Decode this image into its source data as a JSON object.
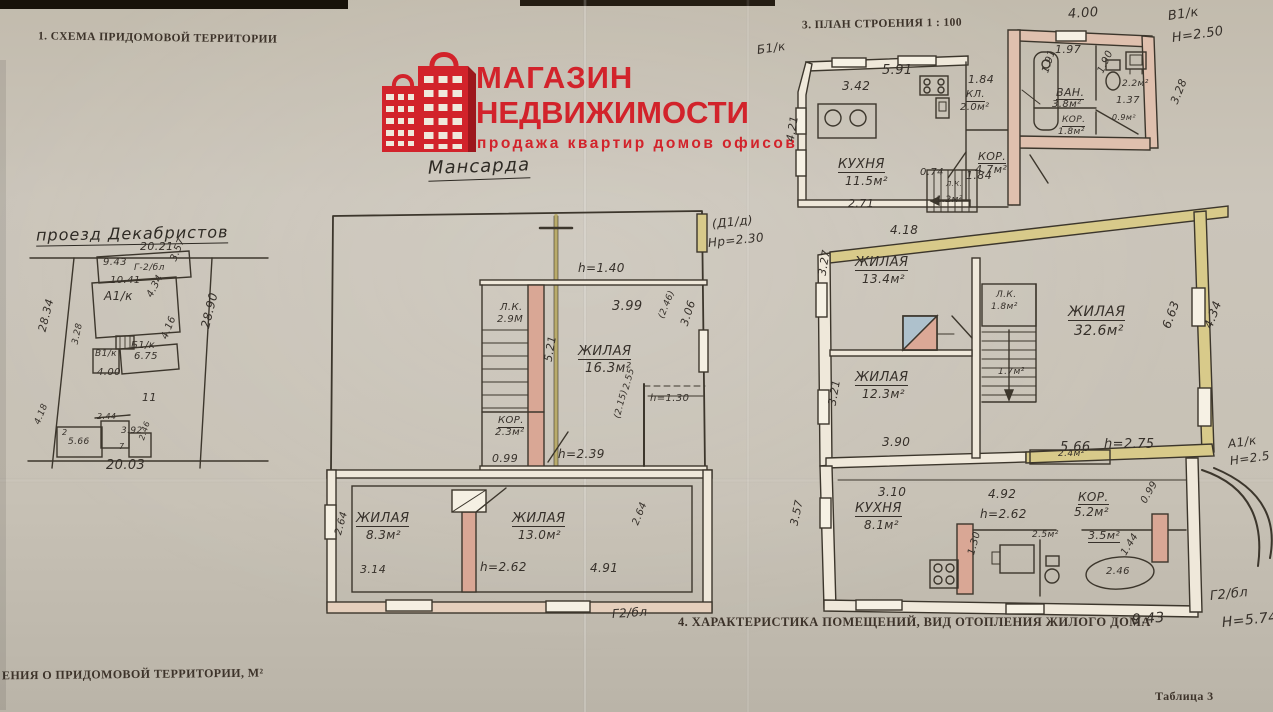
{
  "page": {
    "section1_title": "1. СХЕМА ПРИДОМОВОЙ ТЕРРИТОРИИ",
    "section3_title": "3. ПЛАН СТРОЕНИЯ 1 : 100",
    "section4_title": "4. ХАРАКТЕРИСТИКА ПОМЕЩЕНИЙ, ВИД ОТОПЛЕНИЯ ЖИЛОГО ДОМА",
    "bottom_left_text": "ЕНИЯ О ПРИДОМОВОЙ ТЕРРИТОРИИ, М²",
    "table_ref": "Таблица 3"
  },
  "logo": {
    "line1": "МАГАЗИН",
    "line2": "НЕДВИЖИМОСТИ",
    "tagline": "продажа  квартир  домов  офисов",
    "brand_color": "#d2232b",
    "icon": "buildings-bag-icon"
  },
  "site_plan": {
    "street_name": "проезд Декабристов",
    "labels": [
      {
        "t": "20.21",
        "x": 140,
        "y": 241,
        "fs": 11
      },
      {
        "t": "28.34",
        "x": 42,
        "y": 326,
        "fs": 11,
        "r": -76
      },
      {
        "t": "28.90",
        "x": 205,
        "y": 322,
        "fs": 12,
        "r": -76
      },
      {
        "t": "9.43",
        "x": 103,
        "y": 258,
        "fs": 10
      },
      {
        "t": "Г-2/бл",
        "x": 134,
        "y": 264,
        "fs": 9
      },
      {
        "t": "3.57",
        "x": 174,
        "y": 256,
        "fs": 10,
        "r": -68
      },
      {
        "t": "10.41",
        "x": 110,
        "y": 276,
        "fs": 10
      },
      {
        "t": "А1/к",
        "x": 104,
        "y": 290,
        "fs": 12
      },
      {
        "t": "4.34",
        "x": 150,
        "y": 292,
        "fs": 10,
        "r": -62
      },
      {
        "t": "4.16",
        "x": 165,
        "y": 334,
        "fs": 10,
        "r": -68
      },
      {
        "t": "Б1/к",
        "x": 131,
        "y": 341,
        "fs": 10
      },
      {
        "t": "6.75",
        "x": 134,
        "y": 352,
        "fs": 10
      },
      {
        "t": "В1/к",
        "x": 95,
        "y": 350,
        "fs": 9
      },
      {
        "t": "3.28",
        "x": 76,
        "y": 340,
        "fs": 9,
        "r": -78
      },
      {
        "t": "4.00",
        "x": 97,
        "y": 368,
        "fs": 10
      },
      {
        "t": "11",
        "x": 142,
        "y": 392,
        "fs": 11
      },
      {
        "t": "2.44",
        "x": 97,
        "y": 413,
        "fs": 8
      },
      {
        "t": "4.18",
        "x": 38,
        "y": 420,
        "fs": 9,
        "r": -68
      },
      {
        "t": "2",
        "x": 62,
        "y": 429,
        "fs": 8
      },
      {
        "t": "5.66",
        "x": 68,
        "y": 438,
        "fs": 9
      },
      {
        "t": "3.92",
        "x": 121,
        "y": 427,
        "fs": 9
      },
      {
        "t": "7",
        "x": 119,
        "y": 443,
        "fs": 8
      },
      {
        "t": "2.46",
        "x": 142,
        "y": 436,
        "fs": 8,
        "r": -72
      },
      {
        "t": "20.03",
        "x": 106,
        "y": 459,
        "fs": 13
      }
    ]
  },
  "attic_plan": {
    "title": "Мансарда",
    "labels": [
      {
        "t": "h=1.40",
        "x": 578,
        "y": 262,
        "fs": 12
      },
      {
        "t": "Л.К.",
        "x": 500,
        "y": 303,
        "fs": 10
      },
      {
        "t": "2.9М",
        "x": 497,
        "y": 315,
        "fs": 10
      },
      {
        "t": "3.99",
        "x": 612,
        "y": 300,
        "fs": 13
      },
      {
        "t": "(2.46)",
        "x": 662,
        "y": 314,
        "fs": 9,
        "r": -68
      },
      {
        "t": "3.06",
        "x": 684,
        "y": 320,
        "fs": 11,
        "r": -72
      },
      {
        "t": "ЖИЛАЯ",
        "x": 578,
        "y": 345,
        "fs": 13,
        "u": 1
      },
      {
        "t": "16.3м²",
        "x": 585,
        "y": 362,
        "fs": 13
      },
      {
        "t": "5.21",
        "x": 548,
        "y": 356,
        "fs": 11,
        "r": -80
      },
      {
        "t": "2.55",
        "x": 627,
        "y": 385,
        "fs": 9,
        "r": -75
      },
      {
        "t": "(2.15)",
        "x": 618,
        "y": 414,
        "fs": 9,
        "r": -75
      },
      {
        "t": "h=1.30",
        "x": 650,
        "y": 394,
        "fs": 10
      },
      {
        "t": "КОР.",
        "x": 498,
        "y": 416,
        "fs": 10,
        "u": 1
      },
      {
        "t": "2.3м²",
        "x": 495,
        "y": 428,
        "fs": 10
      },
      {
        "t": "0.99",
        "x": 492,
        "y": 453,
        "fs": 11
      },
      {
        "t": "h=2.39",
        "x": 558,
        "y": 448,
        "fs": 12
      },
      {
        "t": "ЖИЛАЯ",
        "x": 356,
        "y": 512,
        "fs": 13,
        "u": 1
      },
      {
        "t": "8.3м²",
        "x": 366,
        "y": 529,
        "fs": 12
      },
      {
        "t": "2.64",
        "x": 339,
        "y": 530,
        "fs": 10,
        "r": -75
      },
      {
        "t": "3.14",
        "x": 360,
        "y": 564,
        "fs": 11
      },
      {
        "t": "ЖИЛАЯ",
        "x": 512,
        "y": 512,
        "fs": 13,
        "u": 1
      },
      {
        "t": "13.0м²",
        "x": 518,
        "y": 529,
        "fs": 12
      },
      {
        "t": "h=2.62",
        "x": 480,
        "y": 561,
        "fs": 12
      },
      {
        "t": "4.91",
        "x": 590,
        "y": 562,
        "fs": 12
      },
      {
        "t": "2.64",
        "x": 636,
        "y": 520,
        "fs": 10,
        "r": -68
      },
      {
        "t": "Г2/бл",
        "x": 612,
        "y": 608,
        "fs": 12,
        "r": -4
      }
    ]
  },
  "floor_plan": {
    "labels": [
      {
        "t": "Б1/к",
        "x": 757,
        "y": 44,
        "fs": 12,
        "r": -8
      },
      {
        "t": "4.00",
        "x": 1068,
        "y": 8,
        "fs": 13,
        "r": -4
      },
      {
        "t": "В1/к",
        "x": 1168,
        "y": 10,
        "fs": 13,
        "r": -8
      },
      {
        "t": "Н=2.50",
        "x": 1172,
        "y": 32,
        "fs": 13,
        "r": -8
      },
      {
        "t": "5.91",
        "x": 882,
        "y": 64,
        "fs": 13
      },
      {
        "t": "3.42",
        "x": 842,
        "y": 80,
        "fs": 12
      },
      {
        "t": "1.84",
        "x": 968,
        "y": 74,
        "fs": 11
      },
      {
        "t": "КЛ.",
        "x": 966,
        "y": 90,
        "fs": 10,
        "u": 1
      },
      {
        "t": "2.0м²",
        "x": 960,
        "y": 103,
        "fs": 10
      },
      {
        "t": "1.84",
        "x": 966,
        "y": 170,
        "fs": 11
      },
      {
        "t": "1.97",
        "x": 1055,
        "y": 44,
        "fs": 11
      },
      {
        "t": "1.91",
        "x": 1046,
        "y": 68,
        "fs": 10,
        "r": -72
      },
      {
        "t": "ВАН.",
        "x": 1056,
        "y": 87,
        "fs": 11,
        "u": 1
      },
      {
        "t": "3.8м²",
        "x": 1052,
        "y": 100,
        "fs": 10
      },
      {
        "t": "1.90",
        "x": 1101,
        "y": 68,
        "fs": 10,
        "r": -65
      },
      {
        "t": "2.2м²",
        "x": 1122,
        "y": 80,
        "fs": 9
      },
      {
        "t": "1.37",
        "x": 1116,
        "y": 96,
        "fs": 10
      },
      {
        "t": "КОР.",
        "x": 1062,
        "y": 116,
        "fs": 9,
        "u": 1
      },
      {
        "t": "1.8м²",
        "x": 1058,
        "y": 128,
        "fs": 9
      },
      {
        "t": "0.9м²",
        "x": 1112,
        "y": 114,
        "fs": 8
      },
      {
        "t": "3.28",
        "x": 1174,
        "y": 98,
        "fs": 11,
        "r": -68
      },
      {
        "t": "4.21",
        "x": 790,
        "y": 136,
        "fs": 11,
        "r": -80
      },
      {
        "t": "КУХНЯ",
        "x": 838,
        "y": 158,
        "fs": 13,
        "u": 1
      },
      {
        "t": "11.5м²",
        "x": 845,
        "y": 175,
        "fs": 12
      },
      {
        "t": "0.74",
        "x": 920,
        "y": 168,
        "fs": 10
      },
      {
        "t": "Л.К.",
        "x": 946,
        "y": 181,
        "fs": 7
      },
      {
        "t": "1.2м²",
        "x": 936,
        "y": 196,
        "fs": 9
      },
      {
        "t": "КОР.",
        "x": 978,
        "y": 151,
        "fs": 11,
        "u": 1
      },
      {
        "t": "4.7м²",
        "x": 975,
        "y": 164,
        "fs": 11
      },
      {
        "t": "2.71",
        "x": 848,
        "y": 198,
        "fs": 11
      },
      {
        "t": "(Д1/д)",
        "x": 712,
        "y": 218,
        "fs": 12,
        "r": -6
      },
      {
        "t": "Нр=2.30",
        "x": 708,
        "y": 237,
        "fs": 12,
        "r": -6
      },
      {
        "t": "4.18",
        "x": 890,
        "y": 224,
        "fs": 12
      },
      {
        "t": "ЖИЛАЯ",
        "x": 855,
        "y": 256,
        "fs": 13,
        "u": 1
      },
      {
        "t": "13.4м²",
        "x": 862,
        "y": 273,
        "fs": 12
      },
      {
        "t": "3.27",
        "x": 822,
        "y": 270,
        "fs": 11,
        "r": -80
      },
      {
        "t": "Л.К.",
        "x": 996,
        "y": 291,
        "fs": 9
      },
      {
        "t": "1.8м²",
        "x": 991,
        "y": 303,
        "fs": 9
      },
      {
        "t": "ЖИЛАЯ",
        "x": 1068,
        "y": 305,
        "fs": 14,
        "u": 1
      },
      {
        "t": "32.6м²",
        "x": 1074,
        "y": 324,
        "fs": 14
      },
      {
        "t": "6.63",
        "x": 1166,
        "y": 322,
        "fs": 12,
        "r": -70
      },
      {
        "t": "4.34",
        "x": 1208,
        "y": 322,
        "fs": 12,
        "r": -70
      },
      {
        "t": "ЖИЛАЯ",
        "x": 855,
        "y": 371,
        "fs": 13,
        "u": 1
      },
      {
        "t": "12.3м²",
        "x": 862,
        "y": 388,
        "fs": 12
      },
      {
        "t": "1.7м²",
        "x": 998,
        "y": 368,
        "fs": 9
      },
      {
        "t": "3.21",
        "x": 832,
        "y": 400,
        "fs": 11,
        "r": -80
      },
      {
        "t": "3.90",
        "x": 882,
        "y": 436,
        "fs": 12
      },
      {
        "t": "5.66",
        "x": 1060,
        "y": 441,
        "fs": 13
      },
      {
        "t": "h=2.75",
        "x": 1104,
        "y": 438,
        "fs": 13
      },
      {
        "t": "А1/к",
        "x": 1228,
        "y": 438,
        "fs": 12,
        "r": -8
      },
      {
        "t": "Н=2.5",
        "x": 1230,
        "y": 455,
        "fs": 12,
        "r": -8
      },
      {
        "t": "2.4м²",
        "x": 1058,
        "y": 450,
        "fs": 9
      },
      {
        "t": "3.10",
        "x": 878,
        "y": 486,
        "fs": 12
      },
      {
        "t": "КУХНЯ",
        "x": 855,
        "y": 502,
        "fs": 13,
        "u": 1
      },
      {
        "t": "8.1м²",
        "x": 864,
        "y": 519,
        "fs": 12
      },
      {
        "t": "3.57",
        "x": 794,
        "y": 520,
        "fs": 11,
        "r": -78
      },
      {
        "t": "4.92",
        "x": 988,
        "y": 488,
        "fs": 12
      },
      {
        "t": "h=2.62",
        "x": 980,
        "y": 508,
        "fs": 12
      },
      {
        "t": "КОР.",
        "x": 1078,
        "y": 491,
        "fs": 12,
        "u": 1
      },
      {
        "t": "5.2м²",
        "x": 1074,
        "y": 506,
        "fs": 12
      },
      {
        "t": "0.99",
        "x": 1144,
        "y": 498,
        "fs": 10,
        "r": -60
      },
      {
        "t": "2.5м²",
        "x": 1032,
        "y": 531,
        "fs": 9
      },
      {
        "t": "3.5м²",
        "x": 1088,
        "y": 530,
        "fs": 11,
        "u": 1
      },
      {
        "t": "1.30",
        "x": 972,
        "y": 550,
        "fs": 10,
        "r": -75
      },
      {
        "t": "2.46",
        "x": 1106,
        "y": 567,
        "fs": 10
      },
      {
        "t": "1.44",
        "x": 1124,
        "y": 550,
        "fs": 10,
        "r": -58
      },
      {
        "t": "Г2/бл",
        "x": 1210,
        "y": 590,
        "fs": 13,
        "r": -6
      },
      {
        "t": "9.43",
        "x": 1132,
        "y": 613,
        "fs": 14,
        "r": -4
      },
      {
        "t": "Н=5.74",
        "x": 1222,
        "y": 616,
        "fs": 14,
        "r": -6
      }
    ]
  }
}
